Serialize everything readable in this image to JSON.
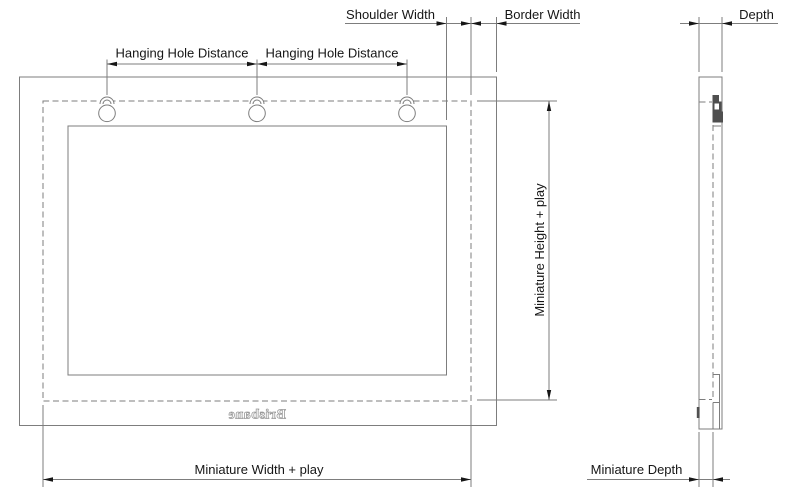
{
  "labels": {
    "shoulder_width": "Shoulder Width",
    "border_width": "Border Width",
    "depth": "Depth",
    "hanging_hole_distance": "Hanging Hole Distance",
    "miniature_height_play": "Miniature Height + play",
    "miniature_width_play": "Miniature Width + play",
    "miniature_depth": "Miniature Depth",
    "brand": "Brisbane"
  },
  "colors": {
    "background": "#ffffff",
    "line": "#7d7d7d",
    "arrow": "#161616",
    "text": "#161616",
    "keyhole_fill": "#4f4f4f",
    "brand_stroke": "#9a9a9a"
  }
}
